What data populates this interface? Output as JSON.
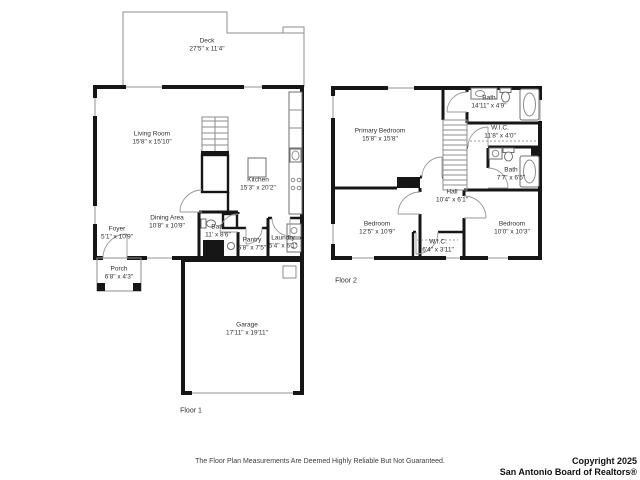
{
  "floors": [
    {
      "label": "Floor 1",
      "rooms": [
        {
          "name": "Deck",
          "dims": "27'5\" x 11'4\""
        },
        {
          "name": "Living Room",
          "dims": "15'8\" x 15'10\""
        },
        {
          "name": "Kitchen",
          "dims": "15'3\" x 20'2\""
        },
        {
          "name": "Dining Area",
          "dims": "10'8\" x 10'9\""
        },
        {
          "name": "Foyer",
          "dims": "5'1\" x 10'9\""
        },
        {
          "name": "Bath",
          "dims": "11' x 8'6\""
        },
        {
          "name": "Pantry",
          "dims": "5'8\" x 7'5\""
        },
        {
          "name": "Laundry",
          "dims": "5'4\" x 6'1\""
        },
        {
          "name": "Porch",
          "dims": "6'8\" x 4'3\""
        },
        {
          "name": "Garage",
          "dims": "17'11\" x 19'11\""
        }
      ]
    },
    {
      "label": "Floor 2",
      "rooms": [
        {
          "name": "Primary Bedroom",
          "dims": "15'8\" x 15'8\""
        },
        {
          "name": "Bath",
          "dims": "14'11\" x 4'9\""
        },
        {
          "name": "W.I.C.",
          "dims": "11'8\" x 4'0\""
        },
        {
          "name": "Bath",
          "dims": "7'7\" x 6'5\""
        },
        {
          "name": "Hall",
          "dims": "10'4\" x 6'1\""
        },
        {
          "name": "Bedroom",
          "dims": "12'5\" x 10'9\""
        },
        {
          "name": "Bedroom",
          "dims": "10'0\" x 10'3\""
        },
        {
          "name": "W.I.C.",
          "dims": "6'4\" x 3'11\""
        }
      ]
    }
  ],
  "footer": {
    "disclaimer": "The Floor Plan Measurements Are Deemed Highly Reliable But Not Guaranteed.",
    "copyright_line1": "Copyright 2025",
    "copyright_line2": "San Antonio Board of Realtors®"
  }
}
